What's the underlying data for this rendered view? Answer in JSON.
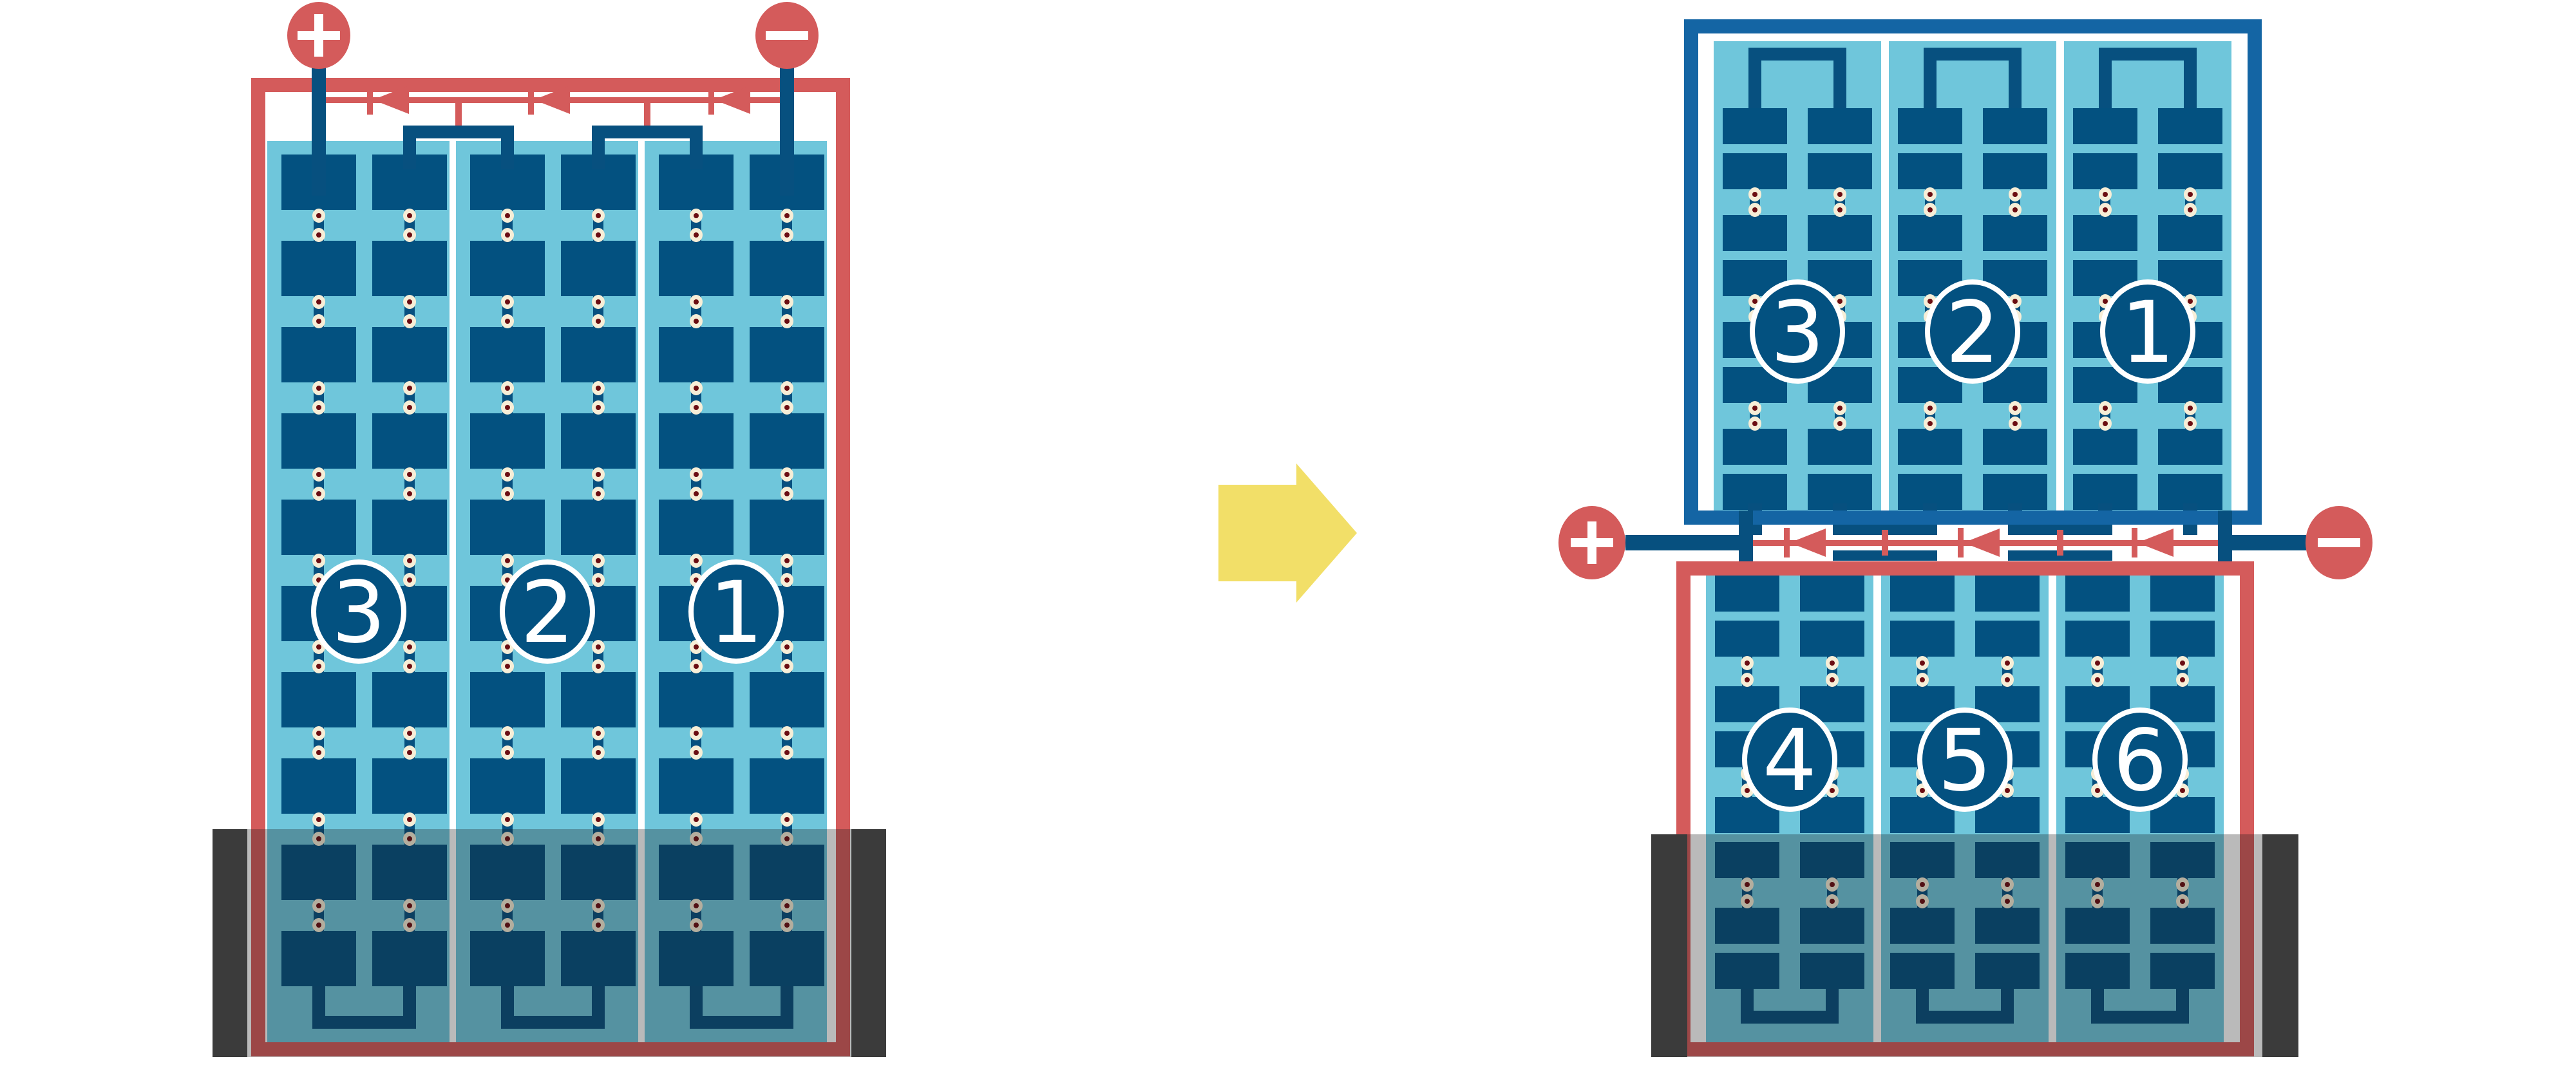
{
  "diagram": {
    "type": "solar-module-bypass-diode-wiring",
    "transition_arrow": {
      "direction": "right"
    },
    "left_module": {
      "frame": "red",
      "cell_style": "full-cell",
      "string_labels": [
        "3",
        "2",
        "1"
      ],
      "rows": 10,
      "columns_per_string": 2,
      "bypass_diodes": 3,
      "terminals": {
        "positive": "+",
        "negative": "−"
      },
      "shaded_bottom": true
    },
    "right_top_module": {
      "frame": "navy",
      "cell_style": "half-cell",
      "string_labels": [
        "3",
        "2",
        "1"
      ],
      "row_pairs": 4,
      "columns_per_string": 2,
      "shaded_bottom": false
    },
    "right_bottom_module": {
      "frame": "red",
      "cell_style": "half-cell",
      "string_labels": [
        "4",
        "5",
        "6"
      ],
      "row_pairs": 4,
      "columns_per_string": 2,
      "shaded_bottom": true
    },
    "junction": {
      "bypass_diodes": 3,
      "terminals": {
        "positive": "+",
        "negative": "−"
      }
    }
  },
  "colors": {
    "background": "#ffffff",
    "panel_blue": "#6fc6db",
    "cell_navy": "#035180",
    "wire_navy": "#07507f",
    "frame_navy": "#1465a4",
    "circuit_red": "#d45b5b",
    "dot_outer": "#f7eed7",
    "dot_inner": "#6b0d12",
    "badge_fill": "#035180",
    "badge_stroke": "#ffffff",
    "terminal_glyph": "#ffffff",
    "shadow_bar": "#3b3b3b",
    "shadow_overlay": "rgba(25,25,25,0.30)",
    "arrow_yellow": "#f2df68"
  }
}
